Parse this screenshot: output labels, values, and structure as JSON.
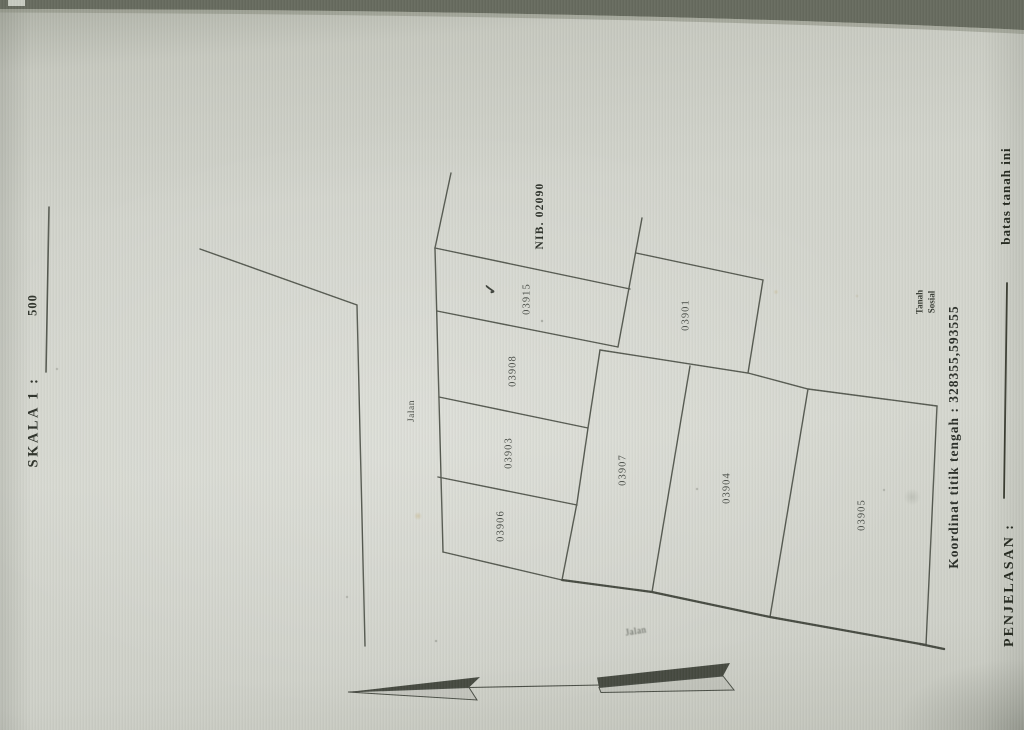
{
  "scale": {
    "label": "SKALA 1 :",
    "value": "500"
  },
  "nib": {
    "label": "NIB. 02090"
  },
  "parcels": [
    {
      "id": "03915"
    },
    {
      "id": "03908"
    },
    {
      "id": "03903"
    },
    {
      "id": "03906"
    },
    {
      "id": "03901"
    },
    {
      "id": "03907"
    },
    {
      "id": "03904"
    },
    {
      "id": "03905"
    }
  ],
  "marks": {
    "checkmark": "✓"
  },
  "roads": {
    "top": "Jalan",
    "bottom": "Jalan"
  },
  "area": {
    "line1": "Tanah",
    "line2": "Sosial"
  },
  "footer": {
    "koordinat": "Koordinat titik tengah : 328355,593555"
  },
  "legend": {
    "label": "PENJELASAN :",
    "value": "batas tanah ini"
  }
}
